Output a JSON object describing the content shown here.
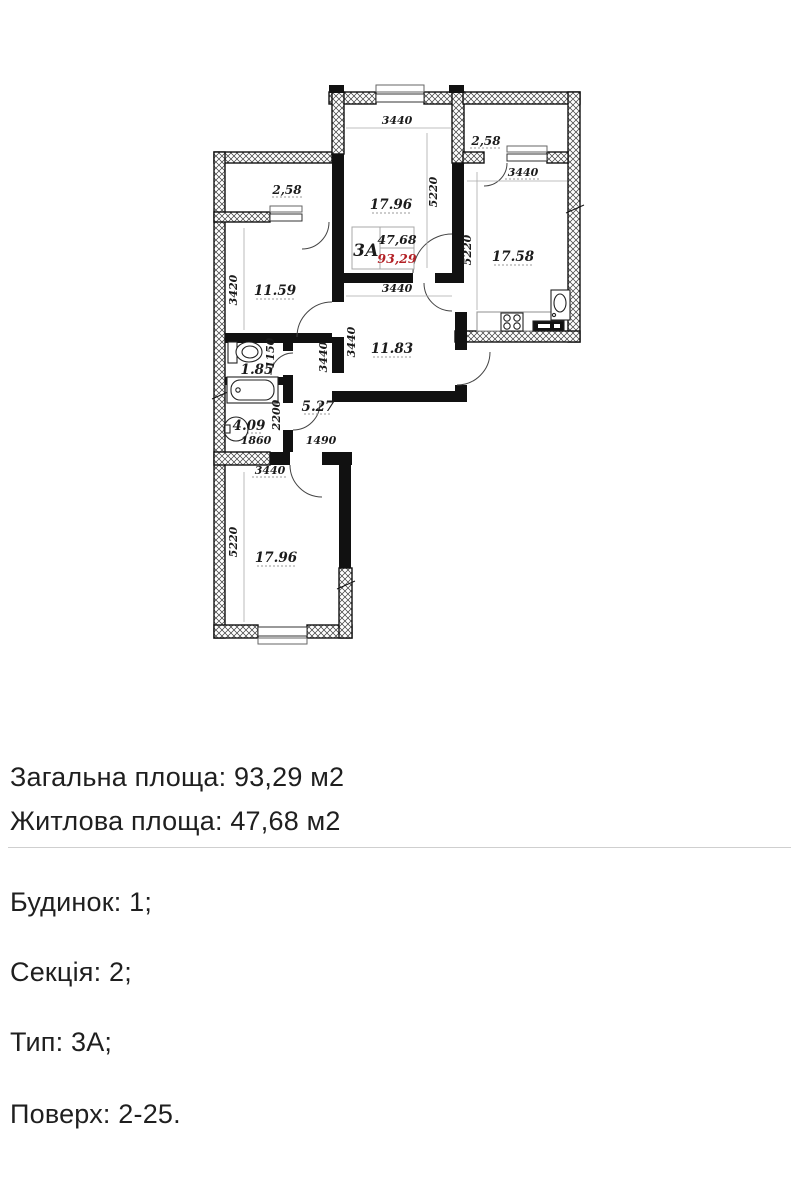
{
  "plan": {
    "type_box": {
      "type": "3А",
      "living_area": "47,68",
      "total_area": "93,29"
    },
    "areas": {
      "balcony_left": "2,58",
      "balcony_right": "2,58",
      "living": "17.96",
      "bedroom": "11.59",
      "kitchen": "17.58",
      "wc": "1.85",
      "bath": "4.09",
      "hall": "5.27",
      "corridor": "11.83",
      "bedroom2": "17.96"
    },
    "dims": {
      "living_top": "3440",
      "living_right": "5220",
      "kitchen_top": "3440",
      "kitchen_left": "5220",
      "bedroom_left": "3420",
      "corridor_top": "3440",
      "wc_right": "1150",
      "corridor_left_a": "3440",
      "corridor_left_b": "3440",
      "bath_right": "2200",
      "bath_bottom": "1860",
      "hall_bottom": "1490",
      "bedroom2_top": "3440",
      "bedroom2_left": "5220"
    },
    "colors": {
      "wall": "#111111",
      "accent_red": "#b32025"
    }
  },
  "info": {
    "area_lines": [
      "Загальна площа: 93,29 м2",
      "Житлова площа: 47,68 м2"
    ],
    "detail_lines": [
      "Будинок: 1;",
      "Секція: 2;",
      "Тип: 3А;",
      "Поверх: 2-25."
    ]
  }
}
